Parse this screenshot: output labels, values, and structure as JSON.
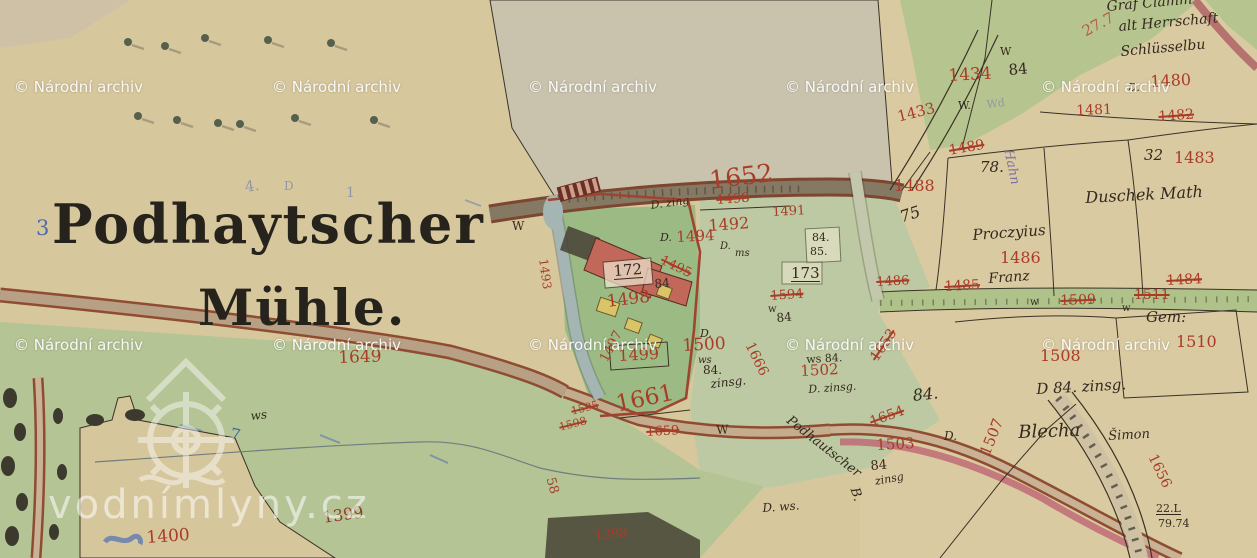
{
  "map": {
    "title_line1": "Podhaytscher",
    "title_line2": "Mühle.",
    "watermark_text": "© Národní archiv",
    "watermark_positions": [
      [
        14,
        78
      ],
      [
        272,
        78
      ],
      [
        528,
        78
      ],
      [
        785,
        78
      ],
      [
        1041,
        78
      ],
      [
        14,
        336
      ],
      [
        272,
        336
      ],
      [
        528,
        336
      ],
      [
        785,
        336
      ],
      [
        1041,
        336
      ]
    ],
    "brand_watermark": "vodnímlyny.cz",
    "colors": {
      "paper": "#d7c79d",
      "field_green": "#b4c494",
      "pale_field": "#c9c3ae",
      "parcel_number_red": "#a93c28",
      "ink_black": "#33291e",
      "road_edge_red": "#8f4c32",
      "water_channel": "#a4b5b3",
      "building_red": "#c2685a",
      "building_yellow": "#d9c567",
      "stream_pink": "#c06b76"
    },
    "labels": [
      {
        "t": "1434",
        "x": 948,
        "y": 68,
        "s": 17,
        "c": "red",
        "r": -3
      },
      {
        "t": "84",
        "x": 1008,
        "y": 63,
        "s": 15,
        "c": "black",
        "r": -5
      },
      {
        "t": "W",
        "x": 1000,
        "y": 46,
        "s": 11,
        "c": "black"
      },
      {
        "t": "27.7",
        "x": 1080,
        "y": 26,
        "s": 15,
        "c": "redlight",
        "r": -28
      },
      {
        "t": "D.",
        "x": 1128,
        "y": 82,
        "s": 11,
        "c": "black",
        "cursive": 1
      },
      {
        "t": "1480",
        "x": 1150,
        "y": 74,
        "s": 16,
        "c": "red",
        "r": -3
      },
      {
        "t": "1481",
        "x": 1076,
        "y": 104,
        "s": 14,
        "c": "red",
        "r": -2
      },
      {
        "t": "1482",
        "x": 1158,
        "y": 110,
        "s": 14,
        "c": "red",
        "r": -4,
        "crossed": 1
      },
      {
        "t": "1433",
        "x": 896,
        "y": 110,
        "s": 15,
        "c": "red",
        "r": -14
      },
      {
        "t": "W.",
        "x": 958,
        "y": 100,
        "s": 11,
        "c": "black"
      },
      {
        "t": "Wd",
        "x": 986,
        "y": 99,
        "s": 11,
        "c": "pencil",
        "r": -6
      },
      {
        "t": "Graf Clamm",
        "x": 1106,
        "y": 0,
        "s": 14,
        "c": "black",
        "cursive": 1,
        "r": -5
      },
      {
        "t": "alt Herrschaft",
        "x": 1118,
        "y": 20,
        "s": 14,
        "c": "black",
        "cursive": 1,
        "r": -5
      },
      {
        "t": "Schlüsselbu",
        "x": 1120,
        "y": 45,
        "s": 14,
        "c": "black",
        "cursive": 1,
        "r": -5
      },
      {
        "t": "32",
        "x": 1144,
        "y": 148,
        "s": 15,
        "c": "black",
        "cursive": 1
      },
      {
        "t": "1483",
        "x": 1174,
        "y": 150,
        "s": 16,
        "c": "red"
      },
      {
        "t": "Duschek Math",
        "x": 1085,
        "y": 190,
        "s": 16,
        "c": "black",
        "cursive": 1,
        "r": -3
      },
      {
        "t": "1489",
        "x": 948,
        "y": 144,
        "s": 14,
        "c": "red",
        "r": -10,
        "crossed": 1
      },
      {
        "t": "1488",
        "x": 894,
        "y": 178,
        "s": 16,
        "c": "red"
      },
      {
        "t": "78.",
        "x": 980,
        "y": 160,
        "s": 15,
        "c": "black",
        "cursive": 1
      },
      {
        "t": "Hahn",
        "x": 1014,
        "y": 148,
        "s": 13,
        "c": "purple",
        "cursive": 1,
        "r": 78
      },
      {
        "t": "75",
        "x": 898,
        "y": 210,
        "s": 16,
        "c": "black",
        "cursive": 1,
        "r": -18
      },
      {
        "t": "Proczyius",
        "x": 972,
        "y": 228,
        "s": 15,
        "c": "black",
        "cursive": 1,
        "r": -4
      },
      {
        "t": "1486",
        "x": 1000,
        "y": 250,
        "s": 16,
        "c": "red"
      },
      {
        "t": "Franz",
        "x": 988,
        "y": 272,
        "s": 14,
        "c": "black",
        "cursive": 1,
        "r": -4
      },
      {
        "t": "1486",
        "x": 876,
        "y": 276,
        "s": 13,
        "c": "red",
        "crossed": 1,
        "r": -3
      },
      {
        "t": "1485",
        "x": 944,
        "y": 280,
        "s": 14,
        "c": "red",
        "crossed": 1,
        "r": -3
      },
      {
        "t": "1509",
        "x": 1060,
        "y": 294,
        "s": 14,
        "c": "red",
        "crossed": 1,
        "r": -2
      },
      {
        "t": "1511",
        "x": 1134,
        "y": 288,
        "s": 14,
        "c": "red",
        "crossed": 1
      },
      {
        "t": "1484",
        "x": 1166,
        "y": 274,
        "s": 14,
        "c": "red",
        "crossed": 1,
        "r": -3
      },
      {
        "t": "w",
        "x": 1030,
        "y": 298,
        "s": 10,
        "c": "black"
      },
      {
        "t": "w",
        "x": 1122,
        "y": 304,
        "s": 10,
        "c": "black"
      },
      {
        "t": "Gem:",
        "x": 1146,
        "y": 310,
        "s": 15,
        "c": "black",
        "cursive": 1
      },
      {
        "t": "1510",
        "x": 1176,
        "y": 334,
        "s": 16,
        "c": "red"
      },
      {
        "t": "1508",
        "x": 1040,
        "y": 348,
        "s": 16,
        "c": "red"
      },
      {
        "t": "D 84. zinsg.",
        "x": 1036,
        "y": 382,
        "s": 15,
        "c": "black",
        "cursive": 1,
        "r": -3
      },
      {
        "t": "Blecha",
        "x": 1018,
        "y": 424,
        "s": 18,
        "c": "black",
        "cursive": 1,
        "r": -2
      },
      {
        "t": "Šimon",
        "x": 1108,
        "y": 430,
        "s": 13,
        "c": "black",
        "cursive": 1,
        "r": -3
      },
      {
        "t": "1507",
        "x": 978,
        "y": 452,
        "s": 15,
        "c": "red",
        "r": -68
      },
      {
        "t": "1656",
        "x": 1158,
        "y": 452,
        "s": 14,
        "c": "red",
        "r": 64
      },
      {
        "t": "22.L",
        "x": 1156,
        "y": 503,
        "s": 11,
        "c": "black",
        "u": 1
      },
      {
        "t": "79.74",
        "x": 1158,
        "y": 518,
        "s": 11,
        "c": "black"
      },
      {
        "t": "1652",
        "x": 708,
        "y": 168,
        "s": 25,
        "c": "red",
        "r": -7
      },
      {
        "t": "1498",
        "x": 716,
        "y": 194,
        "s": 13,
        "c": "red",
        "r": -4,
        "crossed": 1
      },
      {
        "t": "1491",
        "x": 772,
        "y": 206,
        "s": 13,
        "c": "red",
        "r": -3
      },
      {
        "t": "1492",
        "x": 708,
        "y": 218,
        "s": 16,
        "c": "red",
        "r": -4
      },
      {
        "t": "D. zing",
        "x": 650,
        "y": 200,
        "s": 11,
        "c": "black",
        "cursive": 1,
        "r": -8
      },
      {
        "t": "D.",
        "x": 660,
        "y": 232,
        "s": 11,
        "c": "black",
        "cursive": 1
      },
      {
        "t": "1494",
        "x": 676,
        "y": 230,
        "s": 15,
        "c": "red",
        "r": -3
      },
      {
        "t": "1495",
        "x": 664,
        "y": 254,
        "s": 13,
        "c": "red",
        "r": 26,
        "crossed": 1
      },
      {
        "t": "D.",
        "x": 720,
        "y": 242,
        "s": 10,
        "c": "black",
        "cursive": 1
      },
      {
        "t": "ms",
        "x": 735,
        "y": 249,
        "s": 10,
        "c": "black",
        "cursive": 1
      },
      {
        "t": "1493",
        "x": 549,
        "y": 258,
        "s": 12,
        "c": "red",
        "r": 82
      },
      {
        "t": "W",
        "x": 512,
        "y": 220,
        "s": 12,
        "c": "black"
      },
      {
        "t": "172",
        "x": 613,
        "y": 264,
        "s": 15,
        "c": "black",
        "u": 1,
        "r": -4
      },
      {
        "t": "84",
        "x": 654,
        "y": 278,
        "s": 12,
        "c": "black",
        "r": -5
      },
      {
        "t": "1498",
        "x": 606,
        "y": 294,
        "s": 17,
        "c": "red",
        "r": -7
      },
      {
        "t": "84.",
        "x": 812,
        "y": 232,
        "s": 11,
        "c": "black"
      },
      {
        "t": "85.",
        "x": 810,
        "y": 246,
        "s": 11,
        "c": "black"
      },
      {
        "t": "173",
        "x": 791,
        "y": 266,
        "s": 15,
        "c": "black",
        "u": 1
      },
      {
        "t": "1594",
        "x": 770,
        "y": 290,
        "s": 13,
        "c": "red",
        "crossed": 1,
        "r": -4
      },
      {
        "t": "w",
        "x": 768,
        "y": 305,
        "s": 10,
        "c": "black"
      },
      {
        "t": "84",
        "x": 776,
        "y": 312,
        "s": 12,
        "c": "black",
        "r": -5
      },
      {
        "t": "1499",
        "x": 618,
        "y": 348,
        "s": 16,
        "c": "red",
        "r": -3
      },
      {
        "t": "1497",
        "x": 598,
        "y": 358,
        "s": 13,
        "c": "red",
        "r": -62
      },
      {
        "t": "D.",
        "x": 700,
        "y": 328,
        "s": 11,
        "c": "black",
        "cursive": 1
      },
      {
        "t": "1500",
        "x": 682,
        "y": 338,
        "s": 17,
        "c": "red",
        "r": -3
      },
      {
        "t": "ws",
        "x": 698,
        "y": 356,
        "s": 10,
        "c": "black",
        "cursive": 1
      },
      {
        "t": "84.",
        "x": 703,
        "y": 364,
        "s": 12,
        "c": "black"
      },
      {
        "t": "zinsg.",
        "x": 710,
        "y": 378,
        "s": 12,
        "c": "black",
        "cursive": 1,
        "r": -6
      },
      {
        "t": "1666",
        "x": 755,
        "y": 340,
        "s": 14,
        "c": "red",
        "r": 64
      },
      {
        "t": "ws 84.",
        "x": 806,
        "y": 354,
        "s": 11,
        "c": "black",
        "r": -3
      },
      {
        "t": "1502",
        "x": 800,
        "y": 364,
        "s": 15,
        "c": "red",
        "r": -3
      },
      {
        "t": "D. zinsg.",
        "x": 808,
        "y": 384,
        "s": 11,
        "c": "black",
        "cursive": 1,
        "r": -4
      },
      {
        "t": "1653",
        "x": 868,
        "y": 356,
        "s": 14,
        "c": "red",
        "r": -56,
        "crossed": 1
      },
      {
        "t": "84.",
        "x": 912,
        "y": 388,
        "s": 16,
        "c": "black",
        "cursive": 1,
        "r": -6
      },
      {
        "t": "1654",
        "x": 868,
        "y": 416,
        "s": 14,
        "c": "red",
        "r": -20,
        "crossed": 1
      },
      {
        "t": "Podhautscher",
        "x": 792,
        "y": 414,
        "s": 13,
        "c": "black",
        "cursive": 1,
        "r": 38
      },
      {
        "t": "B.",
        "x": 860,
        "y": 486,
        "s": 13,
        "c": "black",
        "cursive": 1,
        "r": 72
      },
      {
        "t": "1503",
        "x": 876,
        "y": 438,
        "s": 15,
        "c": "red",
        "r": -3
      },
      {
        "t": "84",
        "x": 870,
        "y": 460,
        "s": 13,
        "c": "black",
        "r": -5
      },
      {
        "t": "zinsg",
        "x": 874,
        "y": 476,
        "s": 11,
        "c": "black",
        "cursive": 1,
        "r": -10
      },
      {
        "t": "D.",
        "x": 944,
        "y": 430,
        "s": 12,
        "c": "black",
        "cursive": 1
      },
      {
        "t": "1661",
        "x": 614,
        "y": 394,
        "s": 23,
        "c": "red",
        "r": -12
      },
      {
        "t": "1659",
        "x": 646,
        "y": 426,
        "s": 13,
        "c": "red",
        "crossed": 1,
        "r": -3
      },
      {
        "t": "W",
        "x": 716,
        "y": 424,
        "s": 12,
        "c": "black",
        "r": -3
      },
      {
        "t": "1595",
        "x": 570,
        "y": 406,
        "s": 11,
        "c": "red",
        "crossed": 1,
        "r": -14
      },
      {
        "t": "1598",
        "x": 558,
        "y": 422,
        "s": 11,
        "c": "red",
        "crossed": 1,
        "r": -14
      },
      {
        "t": "58",
        "x": 556,
        "y": 476,
        "s": 13,
        "c": "red",
        "r": 74
      },
      {
        "t": "1649",
        "x": 338,
        "y": 350,
        "s": 17,
        "c": "red",
        "r": -2
      },
      {
        "t": "ws",
        "x": 250,
        "y": 410,
        "s": 12,
        "c": "black",
        "cursive": 1,
        "r": -6
      },
      {
        "t": "7",
        "x": 232,
        "y": 426,
        "s": 16,
        "c": "blue",
        "r": 12
      },
      {
        "t": "1399",
        "x": 322,
        "y": 510,
        "s": 16,
        "c": "darkred",
        "r": -8
      },
      {
        "t": "1400",
        "x": 146,
        "y": 530,
        "s": 17,
        "c": "red",
        "r": -4
      },
      {
        "t": "1398",
        "x": 594,
        "y": 530,
        "s": 13,
        "c": "red",
        "r": -6
      },
      {
        "t": "D. ws.",
        "x": 762,
        "y": 502,
        "s": 12,
        "c": "black",
        "cursive": 1,
        "r": -4
      },
      {
        "t": "3",
        "x": 36,
        "y": 218,
        "s": 21,
        "c": "blue"
      },
      {
        "t": "4.",
        "x": 244,
        "y": 180,
        "s": 15,
        "c": "pencil",
        "r": -8
      },
      {
        "t": "D",
        "x": 284,
        "y": 180,
        "s": 12,
        "c": "pencil"
      },
      {
        "t": "1",
        "x": 346,
        "y": 186,
        "s": 14,
        "c": "pencil"
      }
    ]
  }
}
